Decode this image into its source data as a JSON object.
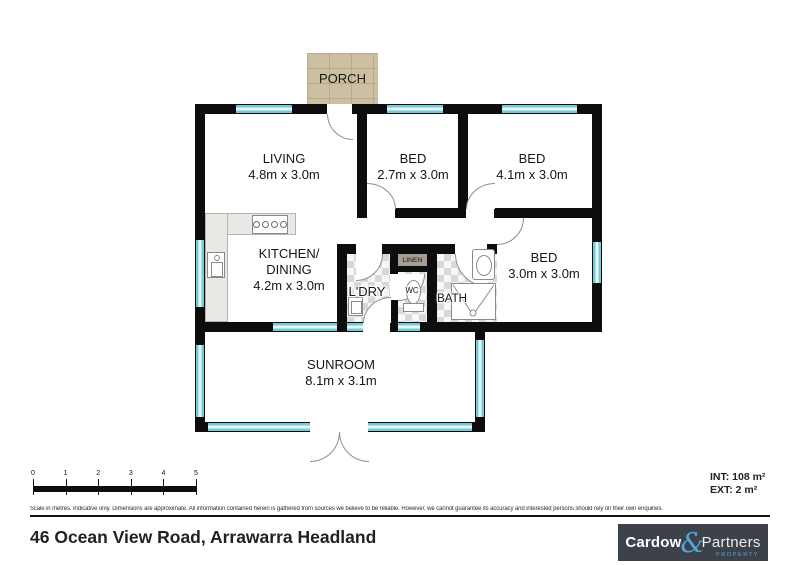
{
  "plan": {
    "porch": {
      "label": "PORCH"
    },
    "rooms": {
      "living": {
        "name": "LIVING",
        "dims": "4.8m x 3.0m"
      },
      "bed1": {
        "name": "BED",
        "dims": "2.7m x 3.0m"
      },
      "bed2": {
        "name": "BED",
        "dims": "4.1m x 3.0m"
      },
      "kitchen": {
        "name": "KITCHEN/",
        "name2": "DINING",
        "dims": "4.2m x 3.0m"
      },
      "laundry": {
        "name": "L'DRY"
      },
      "linen": {
        "name": "LINEN"
      },
      "wc": {
        "name": "WC"
      },
      "bath": {
        "name": "BATH"
      },
      "bed3": {
        "name": "BED",
        "dims": "3.0m x 3.0m"
      },
      "sunroom": {
        "name": "SUNROOM",
        "dims": "8.1m x 3.1m"
      }
    },
    "colors": {
      "wall": "#0d0d0d",
      "window": "#76c9d7",
      "window_pane": "#e8f6f8",
      "porch": "#cdc0a2",
      "fixture": "#e8e8e5",
      "logo_bg": "#3d424a",
      "logo_accent": "#4fa8d8"
    }
  },
  "scale_bar": {
    "ticks": [
      "0",
      "1",
      "2",
      "3",
      "4",
      "5"
    ]
  },
  "areas": {
    "int_label": "INT: 108 m²",
    "ext_label": "EXT: 2 m²"
  },
  "disclaimer": "Scale in metres. Indicative only. Dimensions are approximate. All information contained herein is gathered from sources we believe to be reliable. However, we cannot guarantee its accuracy and interested persons should rely on their own enquiries.",
  "address": "46 Ocean View Road, Arrawarra Headland",
  "logo": {
    "word1": "Cardow",
    "ampersand": "&",
    "word2": "Partners",
    "tagline": "PROPERTY"
  }
}
